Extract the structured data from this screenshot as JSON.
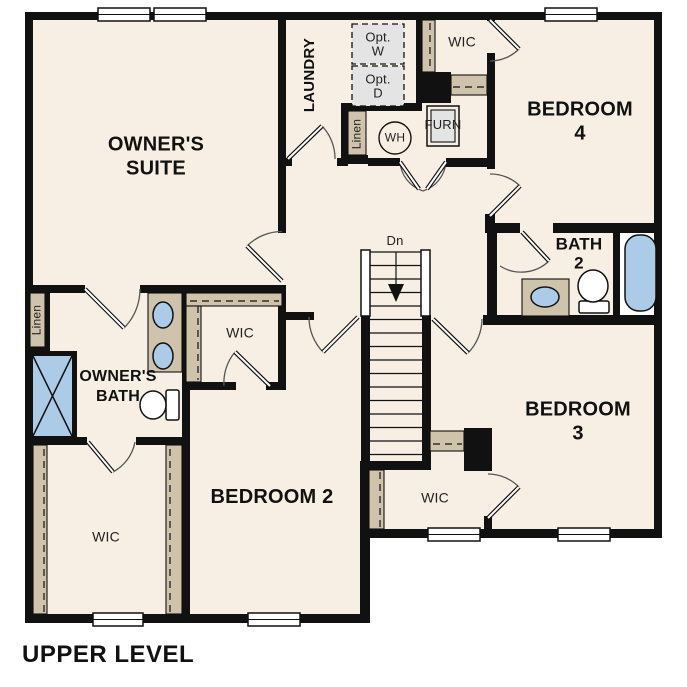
{
  "title": {
    "text": "UPPER LEVEL"
  },
  "plan": {
    "labels": {
      "owners_suite": "OWNER'S\nSUITE",
      "laundry": "LAUNDRY",
      "opt_w": "Opt.\nW",
      "opt_d": "Opt.\nD",
      "wic_top": "WIC",
      "bedroom4": "BEDROOM 4",
      "linen_hall": "Linen",
      "water_heater": "WH",
      "furnace": "FURN",
      "stairs_dn": "Dn",
      "bath2": "BATH\n2",
      "linen_bath": "Linen",
      "owners_bath": "OWNER'S\nBATH",
      "wic_mid": "WIC",
      "wic_owners": "WIC",
      "bedroom2": "BEDROOM 2",
      "bedroom3": "BEDROOM 3",
      "wic_bedroom3": "WIC"
    },
    "colors": {
      "wall": "#111111",
      "floor": "#f7efe3",
      "casework": "#cfc3ab",
      "fixture_blue": "#abcbe7",
      "optional_gray": "#e4e4e4",
      "background": "#ffffff"
    }
  }
}
